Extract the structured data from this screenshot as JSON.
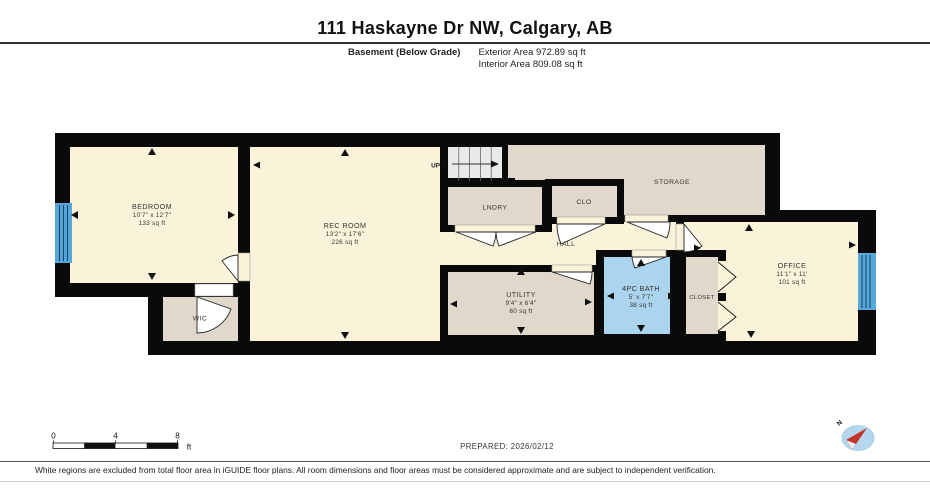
{
  "title": "111 Haskayne Dr NW, Calgary, AB",
  "subtitle": {
    "floor_label": "Basement (Below Grade)",
    "exterior_area": "Exterior Area 972.89 sq ft",
    "interior_area": "Interior Area 809.08 sq ft"
  },
  "rooms": {
    "bedroom": {
      "name": "BEDROOM",
      "dims": "10'7\" x 12'7\"",
      "area": "133 sq ft"
    },
    "rec_room": {
      "name": "REC ROOM",
      "dims": "13'2\" x 17'6\"",
      "area": "226 sq ft"
    },
    "lndry": {
      "name": "LNDRY"
    },
    "clo": {
      "name": "CLO"
    },
    "storage": {
      "name": "STORAGE"
    },
    "hall": {
      "name": "HALL"
    },
    "wic": {
      "name": "WIC"
    },
    "utility": {
      "name": "UTILITY",
      "dims": "9'4\" x 6'4\"",
      "area": "60 sq ft"
    },
    "bath": {
      "name": "4PC BATH",
      "dims": "5' x 7'7\"",
      "area": "38 sq ft"
    },
    "closet": {
      "name": "CLOSET"
    },
    "office": {
      "name": "OFFICE",
      "dims": "11'1\" x 11'",
      "area": "101 sq ft"
    }
  },
  "stairs": {
    "label": "UP"
  },
  "scale_bar": {
    "tick0": "0",
    "tick1": "4",
    "tick2": "8",
    "unit": "ft"
  },
  "prepared": "PREPARED: 2026/02/12",
  "compass": {
    "label": "N"
  },
  "footer": "White regions are excluded from total floor area in iGUIDE floor plans. All room dimensions and floor areas must be considered approximate and are subject to independent verification.",
  "colors": {
    "wall": "#0a0a0a",
    "room_yellow": "#FAF3DA",
    "room_grey": "#DFD8CB",
    "bath_blue": "#ABD4EE",
    "stairs_grey": "#E9E9E9",
    "window_blue": "#58A7D9",
    "compass_blue": "#B5D7EE",
    "compass_red": "#C4342C"
  }
}
